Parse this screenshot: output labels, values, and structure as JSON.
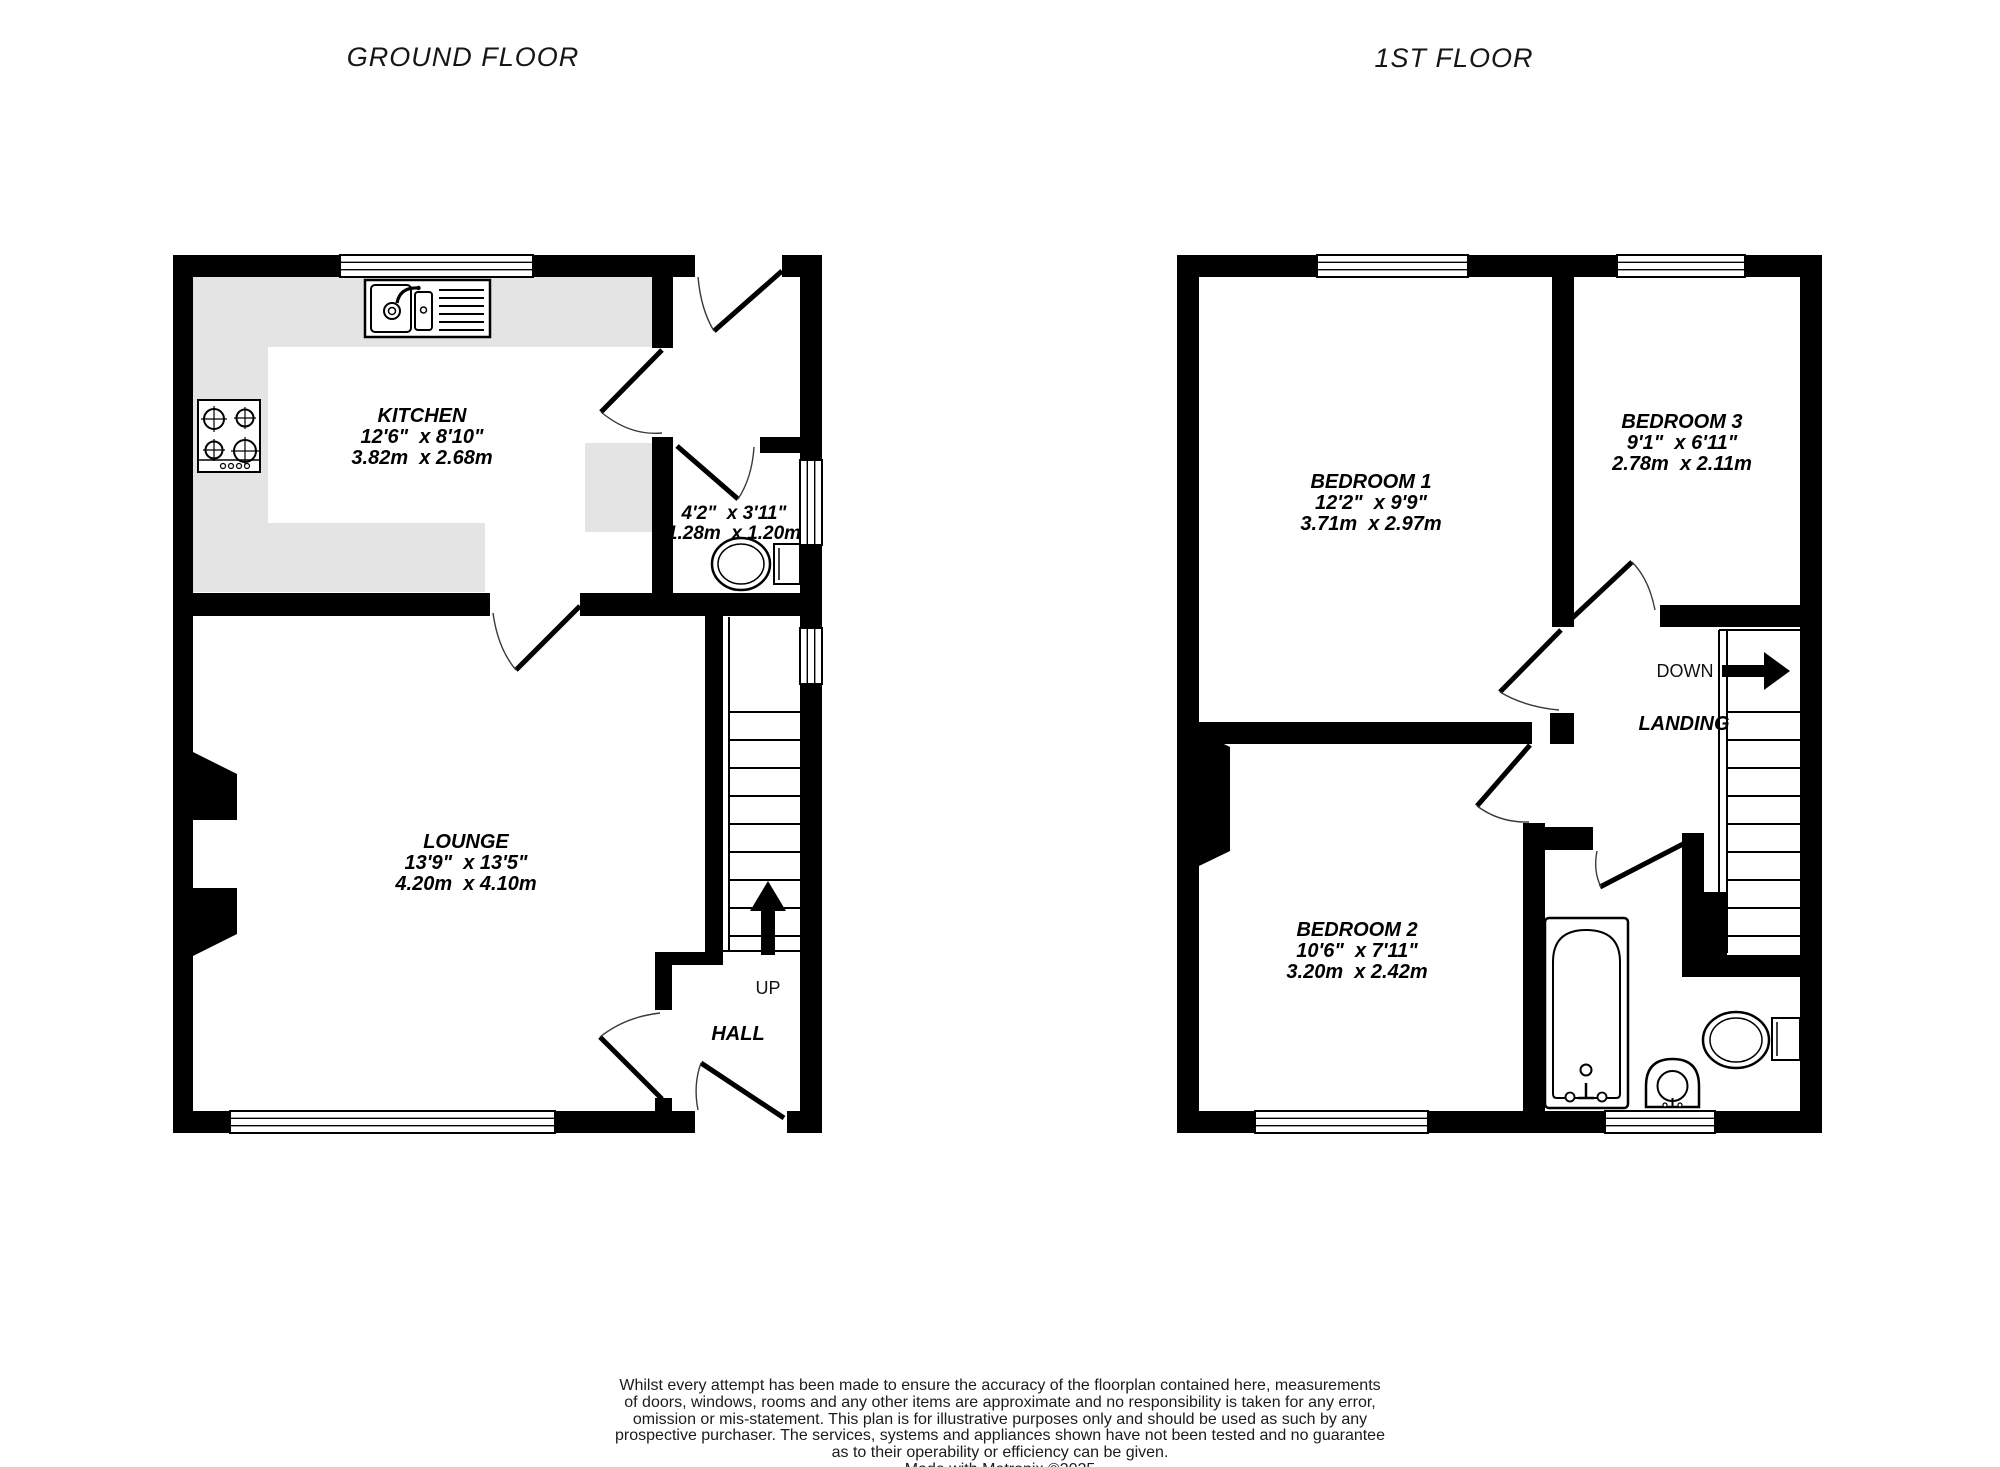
{
  "ground_floor": {
    "title": "GROUND FLOOR",
    "kitchen": {
      "name": "KITCHEN",
      "imperial": "12'6\"  x 8'10\"",
      "metric": "3.82m  x 2.68m"
    },
    "wc": {
      "imperial": "4'2\"  x 3'11\"",
      "metric": "1.28m  x 1.20m"
    },
    "lounge": {
      "name": "LOUNGE",
      "imperial": "13'9\"  x 13'5\"",
      "metric": "4.20m  x 4.10m"
    },
    "hall": {
      "name": "HALL"
    },
    "stairs": {
      "direction": "UP"
    }
  },
  "first_floor": {
    "title": "1ST FLOOR",
    "bedroom1": {
      "name": "BEDROOM 1",
      "imperial": "12'2\"  x 9'9\"",
      "metric": "3.71m  x 2.97m"
    },
    "bedroom2": {
      "name": "BEDROOM 2",
      "imperial": "10'6\"  x 7'11\"",
      "metric": "3.20m  x 2.42m"
    },
    "bedroom3": {
      "name": "BEDROOM 3",
      "imperial": "9'1\"  x 6'11\"",
      "metric": "2.78m  x 2.11m"
    },
    "landing": {
      "name": "LANDING"
    },
    "stairs": {
      "direction": "DOWN"
    }
  },
  "footer": {
    "disclaimer_lines": [
      "Whilst every attempt has been made to ensure the accuracy of the floorplan contained here, measurements",
      "of doors, windows, rooms and any other items are approximate and no responsibility is taken for any error,",
      "omission or mis-statement. This plan is for illustrative purposes only and should be used as such by any",
      "prospective purchaser. The services, systems and appliances shown have not been tested and no guarantee",
      "as to their operability or efficiency can be given."
    ],
    "credit": "Made with Metropix ©2025"
  },
  "colors": {
    "wall": "#000000",
    "worktop": "#e4e4e4",
    "background": "#ffffff",
    "text": "#000000"
  }
}
